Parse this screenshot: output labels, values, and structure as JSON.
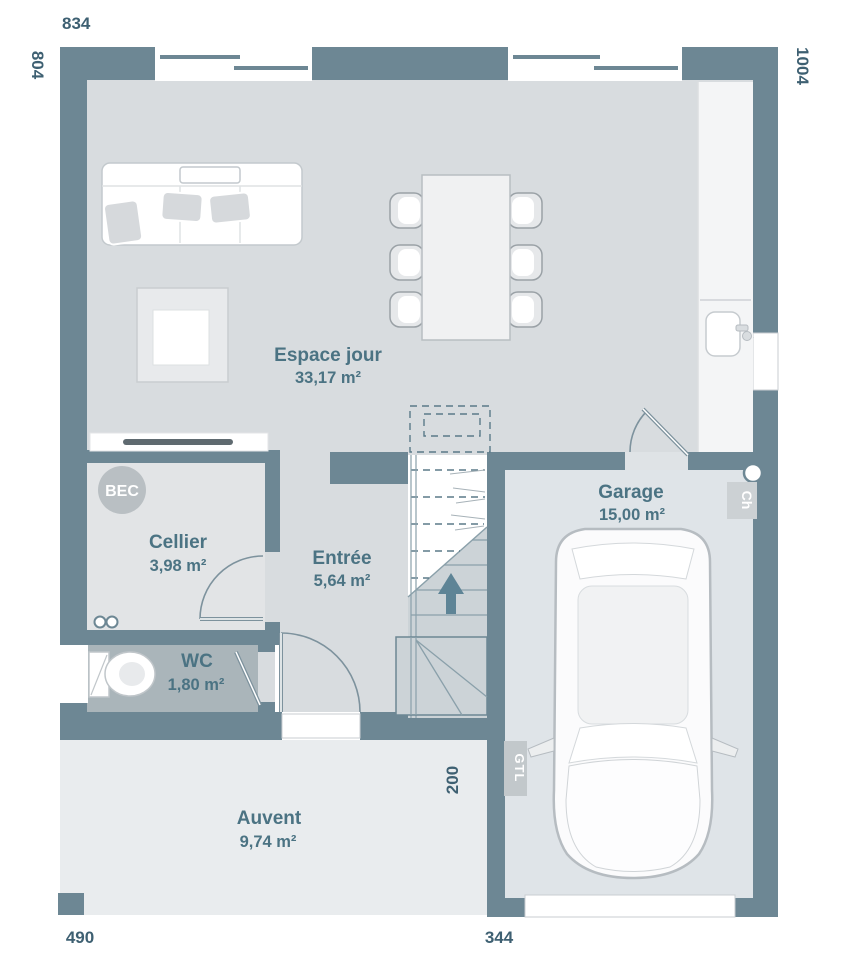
{
  "dimensions_cm": {
    "top": "834",
    "left": "804",
    "right": "1004",
    "bottom_left": "490",
    "bottom_right": "344",
    "porch_depth": "200"
  },
  "rooms": [
    {
      "name": "Espace jour",
      "area": "33,17 m²"
    },
    {
      "name": "Cellier",
      "area": "3,98 m²"
    },
    {
      "name": "Entrée",
      "area": "5,64 m²"
    },
    {
      "name": "WC",
      "area": "1,80 m²"
    },
    {
      "name": "Garage",
      "area": "15,00 m²"
    },
    {
      "name": "Auvent",
      "area": "9,74 m²"
    }
  ],
  "annotations": {
    "bec": "BEC",
    "gtl": "GTL",
    "ch": "Ch"
  },
  "colors": {
    "wall": "#6d8794",
    "room_label": "#4b7383",
    "dimension_label": "#3e6072",
    "floor": "#d8dcdf",
    "cellier_floor": "#e2e4e6",
    "wc_floor": "#aab5ba",
    "garage_floor": "#dfe4e8",
    "auvent_floor": "#e9ecee",
    "stairs_floor": "#ccd3d7"
  }
}
